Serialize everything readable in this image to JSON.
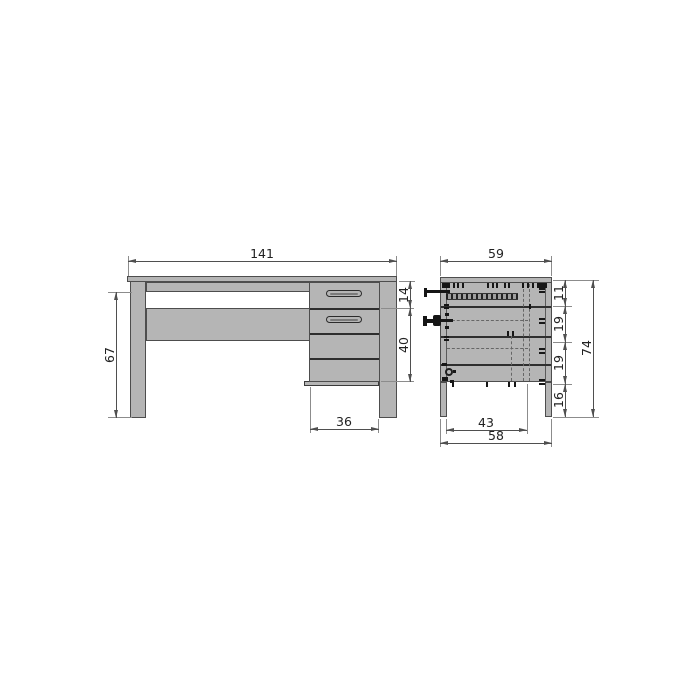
{
  "front_view": {
    "dimensions": {
      "total_width": "141",
      "leg_height": "67",
      "top_drawer_height": "14",
      "drawer_section_height": "40",
      "pedestal_width": "36"
    }
  },
  "side_view": {
    "dimensions": {
      "top_depth": "59",
      "section_1": "11",
      "section_2": "19",
      "section_3": "19",
      "section_4": "16",
      "total_height": "74",
      "inner_leg_spacing": "43",
      "base_depth": "58"
    }
  },
  "colors": {
    "panel_fill": "#b5b5b5",
    "outline": "#4d4d4d",
    "dimension_line": "#4f4f4f",
    "background": "#ffffff"
  }
}
